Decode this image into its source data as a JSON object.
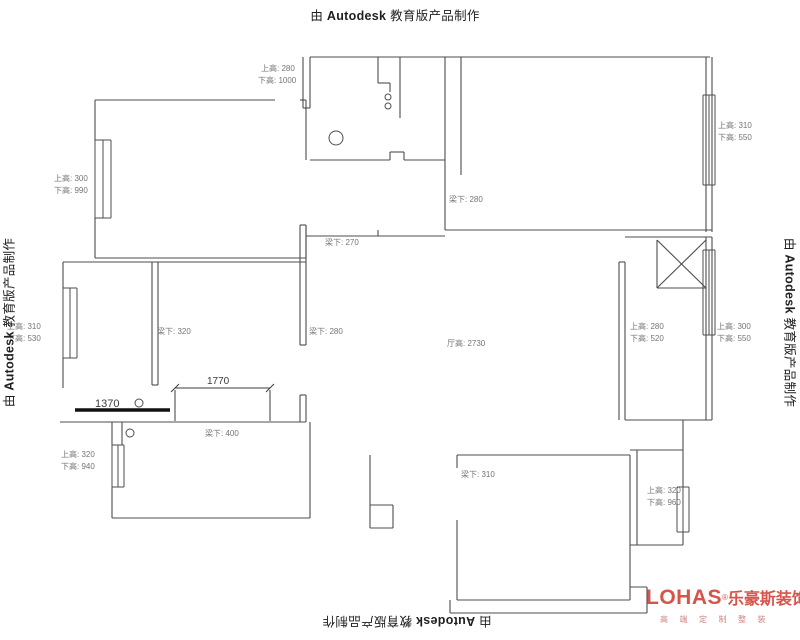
{
  "colors": {
    "wall": "#4d4d4d",
    "label": "#757575",
    "dim": "#3c3c3c",
    "bar": "#111111",
    "stamp": "#1f1f1f",
    "logo": "#d6544a",
    "logo_tagline": "#c9837d"
  },
  "stamp": {
    "prefix": "由",
    "brand": "Autodesk",
    "suffix": "教育版产品制作"
  },
  "logo": {
    "name": "LOHAS",
    "reg": "®",
    "cn": "乐豪斯装饰",
    "tagline": "高端定制整装"
  },
  "plan": {
    "walls": [
      [
        310,
        57,
        710,
        57
      ],
      [
        303,
        57,
        303,
        108
      ],
      [
        310,
        57,
        310,
        108
      ],
      [
        303,
        108,
        310,
        108
      ],
      [
        378,
        57,
        378,
        83
      ],
      [
        378,
        83,
        390,
        83
      ],
      [
        390,
        83,
        390,
        92
      ],
      [
        400,
        57,
        400,
        118
      ],
      [
        445,
        57,
        445,
        230
      ],
      [
        461,
        57,
        461,
        175
      ],
      [
        310,
        160,
        390,
        160
      ],
      [
        390,
        152,
        390,
        160
      ],
      [
        390,
        152,
        404,
        152
      ],
      [
        404,
        152,
        404,
        160
      ],
      [
        404,
        160,
        445,
        160
      ],
      [
        95,
        100,
        275,
        100
      ],
      [
        300,
        100,
        306,
        100
      ],
      [
        95,
        100,
        95,
        140
      ],
      [
        95,
        218,
        95,
        258
      ],
      [
        95,
        258,
        306,
        258
      ],
      [
        306,
        100,
        306,
        160
      ],
      [
        306,
        225,
        306,
        258
      ],
      [
        706,
        57,
        706,
        232
      ],
      [
        712,
        57,
        712,
        232
      ],
      [
        445,
        230,
        712,
        230
      ],
      [
        625,
        237,
        712,
        237
      ],
      [
        619,
        262,
        619,
        420
      ],
      [
        625,
        262,
        625,
        420
      ],
      [
        619,
        262,
        625,
        262
      ],
      [
        706,
        237,
        706,
        420
      ],
      [
        712,
        237,
        712,
        420
      ],
      [
        657,
        240,
        657,
        288
      ],
      [
        657,
        288,
        706,
        288
      ],
      [
        657,
        288,
        706,
        240
      ],
      [
        657,
        240,
        706,
        288
      ],
      [
        625,
        420,
        712,
        420
      ],
      [
        300,
        225,
        300,
        345
      ],
      [
        306,
        225,
        306,
        345
      ],
      [
        300,
        225,
        306,
        225
      ],
      [
        300,
        345,
        306,
        345
      ],
      [
        300,
        395,
        300,
        422
      ],
      [
        306,
        395,
        306,
        422
      ],
      [
        300,
        395,
        306,
        395
      ],
      [
        306,
        236,
        445,
        236
      ],
      [
        378,
        230,
        378,
        236
      ],
      [
        63,
        262,
        306,
        262
      ],
      [
        63,
        262,
        63,
        288
      ],
      [
        63,
        358,
        63,
        388
      ],
      [
        152,
        262,
        152,
        385
      ],
      [
        158,
        262,
        158,
        385
      ],
      [
        152,
        385,
        158,
        385
      ],
      [
        60,
        422,
        306,
        422
      ],
      [
        175,
        390,
        175,
        421
      ],
      [
        270,
        390,
        270,
        421
      ],
      [
        112,
        422,
        112,
        445
      ],
      [
        122,
        422,
        122,
        445
      ],
      [
        112,
        487,
        112,
        518
      ],
      [
        112,
        518,
        310,
        518
      ],
      [
        310,
        422,
        310,
        518
      ],
      [
        370,
        455,
        370,
        528
      ],
      [
        370,
        505,
        393,
        505
      ],
      [
        393,
        505,
        393,
        528
      ],
      [
        370,
        528,
        393,
        528
      ],
      [
        457,
        455,
        630,
        455
      ],
      [
        457,
        455,
        457,
        468
      ],
      [
        457,
        520,
        457,
        600
      ],
      [
        457,
        600,
        630,
        600
      ],
      [
        450,
        600,
        450,
        613
      ],
      [
        450,
        613,
        647,
        613
      ],
      [
        630,
        455,
        630,
        600
      ],
      [
        637,
        450,
        637,
        545
      ],
      [
        630,
        450,
        683,
        450
      ],
      [
        683,
        420,
        683,
        487
      ],
      [
        683,
        532,
        683,
        545
      ],
      [
        630,
        545,
        683,
        545
      ],
      [
        630,
        587,
        647,
        587
      ],
      [
        647,
        587,
        647,
        613
      ]
    ],
    "windows": [
      {
        "lines": [
          95,
          103,
          111
        ],
        "y1": 140,
        "y2": 218
      },
      {
        "lines": [
          703,
          709,
          715
        ],
        "y1": 95,
        "y2": 185
      },
      {
        "lines": [
          63,
          70,
          77
        ],
        "y1": 288,
        "y2": 358
      },
      {
        "lines": [
          703,
          709,
          715
        ],
        "y1": 250,
        "y2": 335
      },
      {
        "lines": [
          112,
          118,
          124
        ],
        "y1": 445,
        "y2": 487
      },
      {
        "lines": [
          677,
          683,
          689
        ],
        "y1": 487,
        "y2": 532
      }
    ],
    "circles": [
      {
        "x": 388,
        "y": 97,
        "r": 3
      },
      {
        "x": 388,
        "y": 106,
        "r": 3
      },
      {
        "x": 336,
        "y": 138,
        "r": 7
      },
      {
        "x": 139,
        "y": 403,
        "r": 4
      },
      {
        "x": 130,
        "y": 433,
        "r": 4
      }
    ],
    "labels": [
      {
        "text": "上高: 280",
        "x": 261,
        "y": 71
      },
      {
        "text": "下高: 1000",
        "x": 258,
        "y": 83
      },
      {
        "text": "上高: 300",
        "x": 54,
        "y": 181
      },
      {
        "text": "下高: 990",
        "x": 54,
        "y": 193
      },
      {
        "text": "上高: 310",
        "x": 718,
        "y": 128
      },
      {
        "text": "下高: 550",
        "x": 718,
        "y": 140
      },
      {
        "text": "梁下: 280",
        "x": 449,
        "y": 202
      },
      {
        "text": "梁下: 270",
        "x": 325,
        "y": 245
      },
      {
        "text": "上高: 310",
        "x": 7,
        "y": 329
      },
      {
        "text": "下高: 530",
        "x": 7,
        "y": 341
      },
      {
        "text": "梁下: 320",
        "x": 157,
        "y": 334
      },
      {
        "text": "梁下: 280",
        "x": 309,
        "y": 334
      },
      {
        "text": "厅高: 2730",
        "x": 447,
        "y": 346
      },
      {
        "text": "上高: 280",
        "x": 630,
        "y": 329
      },
      {
        "text": "下高: 520",
        "x": 630,
        "y": 341
      },
      {
        "text": "上高: 300",
        "x": 717,
        "y": 329
      },
      {
        "text": "下高: 550",
        "x": 717,
        "y": 341
      },
      {
        "text": "梁下: 400",
        "x": 205,
        "y": 436
      },
      {
        "text": "上高: 320",
        "x": 61,
        "y": 457
      },
      {
        "text": "下高: 940",
        "x": 61,
        "y": 469
      },
      {
        "text": "梁下: 310",
        "x": 461,
        "y": 477
      },
      {
        "text": "上高: 320",
        "x": 647,
        "y": 493
      },
      {
        "text": "下高: 960",
        "x": 647,
        "y": 505
      }
    ],
    "dims": {
      "d1770": {
        "text": "1770",
        "tx": 207,
        "ty": 384,
        "line": [
          175,
          388,
          270,
          388
        ],
        "ticks": [
          [
            171,
            392,
            179,
            384
          ],
          [
            266,
            392,
            274,
            384
          ]
        ]
      },
      "d1370": {
        "text": "1370",
        "tx": 95,
        "ty": 407,
        "bar": [
          75,
          410,
          170,
          410
        ]
      }
    }
  }
}
